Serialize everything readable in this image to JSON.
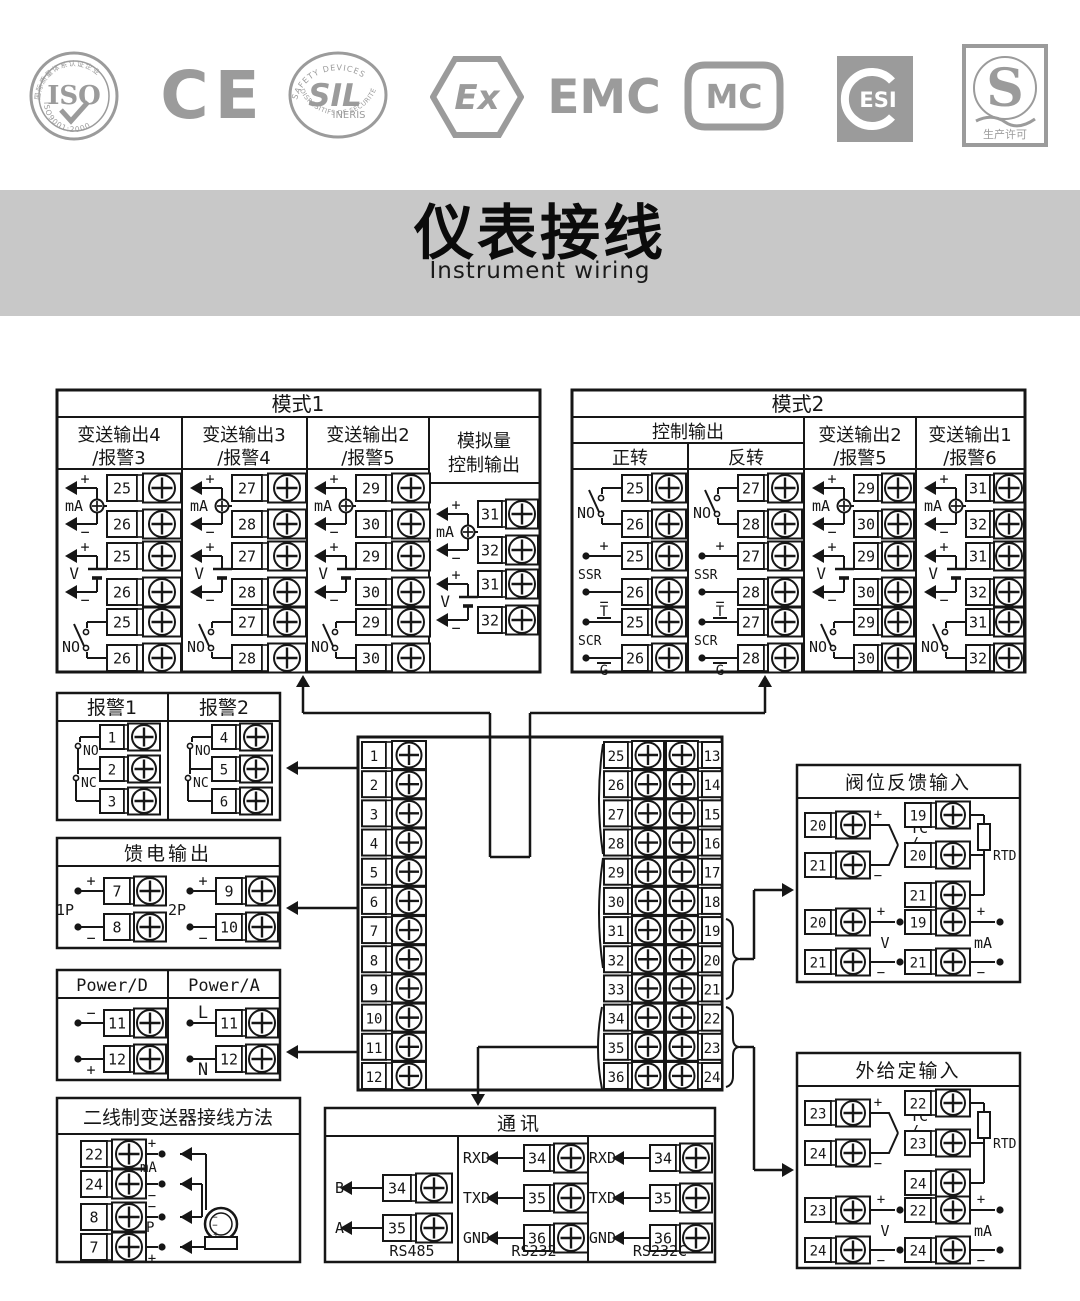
{
  "banner": {
    "title_cn": "仪表接线",
    "title_en": "Instrument wiring"
  },
  "logos": {
    "iso": {
      "center": "ISO",
      "top": "国际质量体系认证企业",
      "bottom": "ISO9001:2000"
    },
    "ce": {
      "text": "CE"
    },
    "sil": {
      "top": "SAFETY DEVICES",
      "center": "SIL",
      "mid": "INERIS",
      "bottom": "DISPOSITIFS DE SÉCURITÉ"
    },
    "ex": {
      "text": "Ex"
    },
    "emc": {
      "text": "EMC"
    },
    "mc": {
      "text": "MC"
    },
    "esi": {
      "text": "ESI"
    },
    "s": {
      "text": "S",
      "bottom": "生产许可"
    }
  },
  "signs": {
    "plus": "+",
    "minus": "−"
  },
  "symbols": {
    "ma": "mA",
    "v": "V",
    "no": "NO",
    "nc": "NC",
    "ssr": "SSR",
    "scr": "SCR",
    "t": "T",
    "g": "G"
  },
  "mode1": {
    "title": "模式1",
    "columns": [
      {
        "header": [
          "变送输出4",
          "/报警3"
        ],
        "types": [
          "mA",
          "V",
          "NO"
        ],
        "terminals": [
          "25",
          "26"
        ]
      },
      {
        "header": [
          "变送输出3",
          "/报警4"
        ],
        "types": [
          "mA",
          "V",
          "NO"
        ],
        "terminals": [
          "27",
          "28"
        ]
      },
      {
        "header": [
          "变送输出2",
          "/报警5"
        ],
        "types": [
          "mA",
          "V",
          "NO"
        ],
        "terminals": [
          "29",
          "30"
        ]
      },
      {
        "header": [
          "模拟量",
          "控制输出"
        ],
        "types": [
          "mA",
          "V"
        ],
        "terminals": [
          "31",
          "32"
        ]
      }
    ]
  },
  "mode2": {
    "title": "模式2",
    "control_header": "控制输出",
    "columns": [
      {
        "header": [
          "正转"
        ],
        "types": [
          "NO",
          "SSR",
          "SCR"
        ],
        "terminals": [
          "25",
          "26"
        ]
      },
      {
        "header": [
          "反转"
        ],
        "types": [
          "NO",
          "SSR",
          "SCR"
        ],
        "terminals": [
          "27",
          "28"
        ]
      },
      {
        "header": [
          "变送输出2",
          "/报警5"
        ],
        "types": [
          "mA",
          "V",
          "NO"
        ],
        "terminals": [
          "29",
          "30"
        ]
      },
      {
        "header": [
          "变送输出1",
          "/报警6"
        ],
        "types": [
          "mA",
          "V",
          "NO"
        ],
        "terminals": [
          "31",
          "32"
        ]
      }
    ]
  },
  "alarm": {
    "columns": [
      {
        "header": "报警1",
        "terminals": [
          "1",
          "2",
          "3"
        ]
      },
      {
        "header": "报警2",
        "terminals": [
          "4",
          "5",
          "6"
        ]
      }
    ]
  },
  "feed": {
    "title": "馈电输出",
    "groups": [
      {
        "label": "1P",
        "terminals": [
          "7",
          "8"
        ]
      },
      {
        "label": "2P",
        "terminals": [
          "9",
          "10"
        ]
      }
    ]
  },
  "power": {
    "columns": [
      {
        "header": "Power/D",
        "top": "−",
        "bottom": "+",
        "terminals": [
          "11",
          "12"
        ]
      },
      {
        "header": "Power/A",
        "top": "L",
        "bottom": "N",
        "terminals": [
          "11",
          "12"
        ]
      }
    ]
  },
  "two_wire": {
    "title": "二线制变送器接线方法",
    "rows": [
      {
        "num": "22",
        "sign": "+",
        "pos": "above"
      },
      {
        "num": "24",
        "sign": "−",
        "pos": "below"
      },
      {
        "num": "8",
        "sign": "−",
        "pos": "above"
      },
      {
        "num": "7",
        "sign": "+",
        "pos": "below"
      }
    ],
    "mid_labels": [
      "mA",
      "P"
    ]
  },
  "center_block": {
    "left": [
      "1",
      "2",
      "3",
      "4",
      "5",
      "6",
      "7",
      "8",
      "9",
      "10",
      "11",
      "12"
    ],
    "mid": [
      "25",
      "26",
      "27",
      "28",
      "29",
      "30",
      "31",
      "32",
      "33",
      "34",
      "35",
      "36"
    ],
    "right": [
      "13",
      "14",
      "15",
      "16",
      "17",
      "18",
      "19",
      "20",
      "21",
      "22",
      "23",
      "24"
    ]
  },
  "comm": {
    "title": "通讯",
    "sections": [
      {
        "caption": "RS485",
        "rows": [
          {
            "label": "B",
            "num": "34"
          },
          {
            "label": "A",
            "num": "35"
          }
        ]
      },
      {
        "caption": "RS232",
        "rows": [
          {
            "label": "RXD",
            "num": "34"
          },
          {
            "label": "TXD",
            "num": "35"
          },
          {
            "label": "GND",
            "num": "36"
          }
        ]
      },
      {
        "caption": "RS232C",
        "rows": [
          {
            "label": "RXD",
            "num": "34"
          },
          {
            "label": "TXD",
            "num": "35"
          },
          {
            "label": "GND",
            "num": "36"
          }
        ]
      }
    ]
  },
  "valve_feedback": {
    "title": "阀位反馈输入",
    "tc": {
      "terminals": [
        "20",
        "21"
      ],
      "labels": [
        "TC",
        "/",
        "mV"
      ]
    },
    "rtd": {
      "terminals": [
        "19",
        "20",
        "21"
      ],
      "label": "RTD"
    },
    "volt": {
      "terminals": [
        "20",
        "21"
      ],
      "label": "V"
    },
    "current": {
      "terminals": [
        "19",
        "21"
      ],
      "label": "mA"
    }
  },
  "external_setpoint": {
    "title": "外给定输入",
    "tc": {
      "terminals": [
        "23",
        "24"
      ],
      "labels": [
        "TC",
        "/",
        "mV"
      ]
    },
    "rtd": {
      "terminals": [
        "22",
        "23",
        "24"
      ],
      "label": "RTD"
    },
    "volt": {
      "terminals": [
        "23",
        "24"
      ],
      "label": "V"
    },
    "current": {
      "terminals": [
        "22",
        "24"
      ],
      "label": "mA"
    }
  }
}
